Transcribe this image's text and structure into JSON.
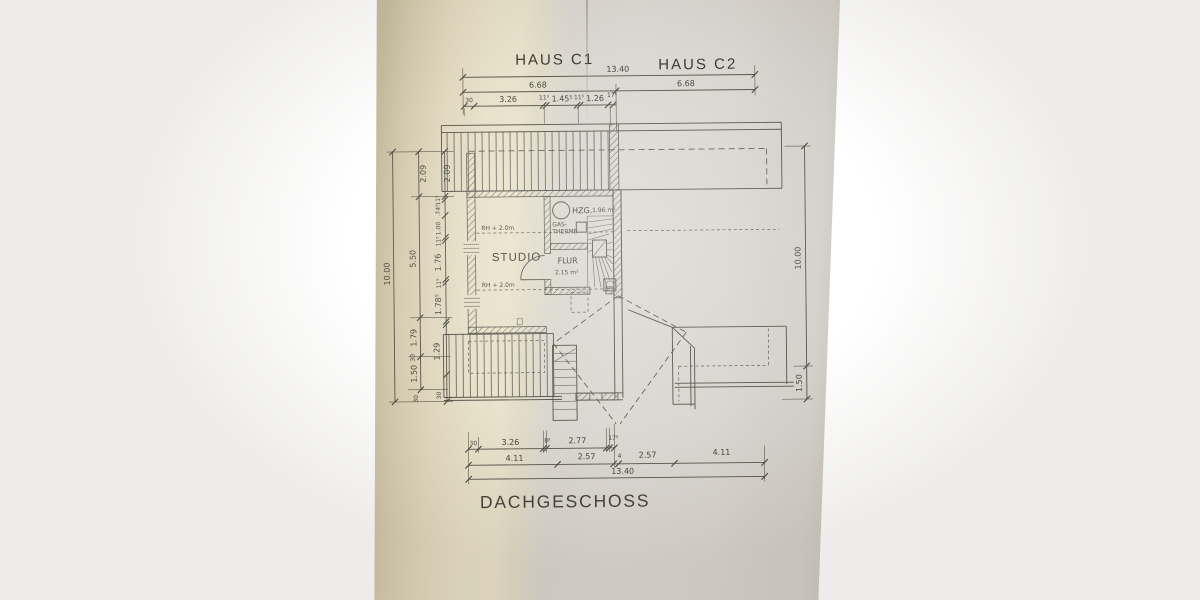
{
  "photo": {
    "background_color": "#ffffff",
    "paper_warm_color": "#e8e1ca",
    "paper_cool_color": "#d9d6d0",
    "ink_color": "#57544a"
  },
  "header": {
    "house_left": "HAUS C1",
    "house_right": "HAUS C2"
  },
  "plan": {
    "studio_label": "STUDIO",
    "flur_label": "FLUR",
    "flur_area": "2.15 m²",
    "hzg_label": "HZG.",
    "hzg_area": "1.96 m²",
    "gas_line1": "GAS-",
    "gas_line2": "THERME",
    "rh_top": "RH + 2.0m",
    "rh_bottom": "RH + 2.0m"
  },
  "dims_top": {
    "total": "13.40",
    "half_left": "6.68",
    "half_right": "6.68",
    "seg_30": "30",
    "seg_326": "3.26",
    "seg_115a": "11⁵",
    "seg_1455": "1.45⁵",
    "seg_115b": "11⁵",
    "seg_126": "1.26",
    "seg_175": "17⁵"
  },
  "dims_bottom": {
    "total": "13.40",
    "seg_30": "30",
    "seg_326": "3.26",
    "seg_85": "8⁵",
    "seg_277": "2.77",
    "seg_175": "17⁵",
    "seg_411a": "4.11",
    "seg_257a": "2.57",
    "seg_4": "4",
    "seg_257b": "2.57",
    "seg_411b": "4.11"
  },
  "dims_left": {
    "total": "10.00",
    "seg_209a": "2.09",
    "seg_209b": "2.09",
    "seg_550": "5.50",
    "seg_115a": "11⁵",
    "seg_745": ".74⁵",
    "seg_100": "1.00",
    "seg_115b": "11⁵",
    "seg_176": "1.76",
    "seg_115c": "11⁵",
    "seg_1785": "1.78⁵",
    "seg_179": "1.79",
    "seg_129": "1.29",
    "seg_150": "1.50",
    "seg_30a": "30",
    "seg_30b": "30",
    "seg_30c": "30"
  },
  "dims_right": {
    "total": "10.00",
    "seg_150": "1.50"
  },
  "title": {
    "floor": "DACHGESCHOSS"
  }
}
